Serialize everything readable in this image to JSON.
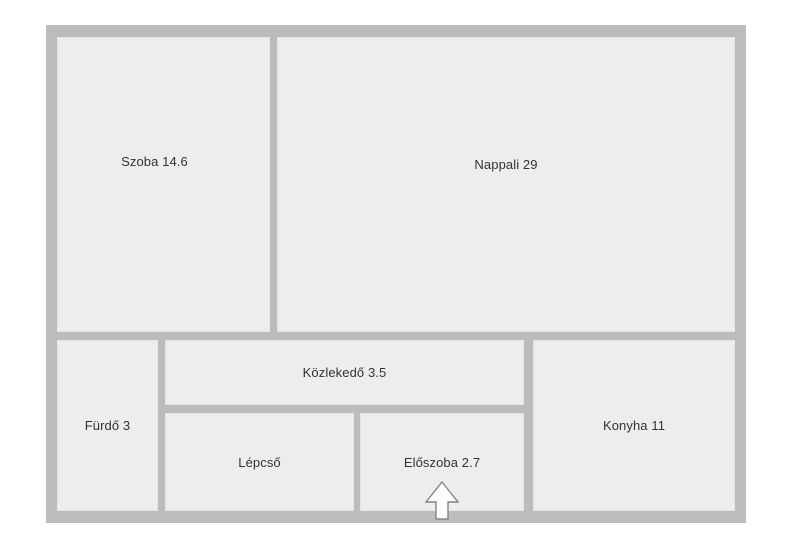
{
  "plan": {
    "wall_color": "#bcbcbc",
    "room_fill": "#ededed",
    "label_color": "#333333",
    "rooms": [
      {
        "name": "szoba",
        "label": "Szoba 14.6"
      },
      {
        "name": "nappali",
        "label": "Nappali 29"
      },
      {
        "name": "furdo",
        "label": "Fürdő 3"
      },
      {
        "name": "kozlekedo",
        "label": "Közlekedő 3.5"
      },
      {
        "name": "lepcso",
        "label": "Lépcső"
      },
      {
        "name": "eloszoba",
        "label": "Előszoba 2.7"
      },
      {
        "name": "konyha",
        "label": "Konyha 11"
      }
    ],
    "entrance": {
      "icon": "entrance-arrow",
      "fill": "#fcfcfc",
      "stroke": "#848484"
    }
  }
}
